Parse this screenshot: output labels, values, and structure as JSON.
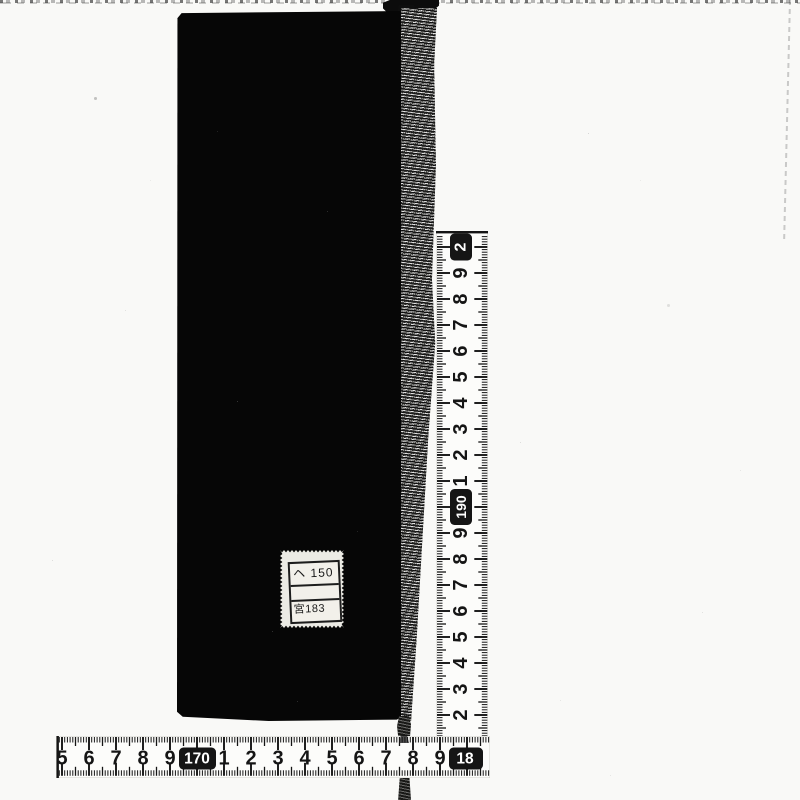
{
  "scene": {
    "type": "archival-scan-of-book-with-tape-measures",
    "colors": {
      "background": "#f9f9f7",
      "book": "#060606",
      "tape": "#fcfcfa",
      "ink": "#151515",
      "sticker": "#ecebe5"
    }
  },
  "sticker": {
    "row1": "ヘ 150",
    "row2": "",
    "row3": "宮183"
  },
  "vertical_tape": {
    "reading_direction": "values-increase-upward",
    "labels": [
      {
        "text": "2",
        "boxed": true,
        "clipped": true
      },
      {
        "text": "9"
      },
      {
        "text": "8"
      },
      {
        "text": "7"
      },
      {
        "text": "6"
      },
      {
        "text": "5"
      },
      {
        "text": "4"
      },
      {
        "text": "3"
      },
      {
        "text": "2"
      },
      {
        "text": "1"
      },
      {
        "text": "190",
        "boxed": true
      },
      {
        "text": "9"
      },
      {
        "text": "8"
      },
      {
        "text": "7"
      },
      {
        "text": "6"
      },
      {
        "text": "5"
      },
      {
        "text": "4"
      },
      {
        "text": "3"
      },
      {
        "text": "2"
      }
    ]
  },
  "horizontal_tape": {
    "reading_direction": "values-increase-rightward",
    "labels": [
      {
        "text": "5"
      },
      {
        "text": "6"
      },
      {
        "text": "7"
      },
      {
        "text": "8"
      },
      {
        "text": "9"
      },
      {
        "text": "170",
        "boxed": true
      },
      {
        "text": "1"
      },
      {
        "text": "2"
      },
      {
        "text": "3"
      },
      {
        "text": "4"
      },
      {
        "text": "5"
      },
      {
        "text": "6"
      },
      {
        "text": "7"
      },
      {
        "text": "8"
      },
      {
        "text": "9"
      },
      {
        "text": "18",
        "boxed": true,
        "clipped": true
      }
    ]
  }
}
